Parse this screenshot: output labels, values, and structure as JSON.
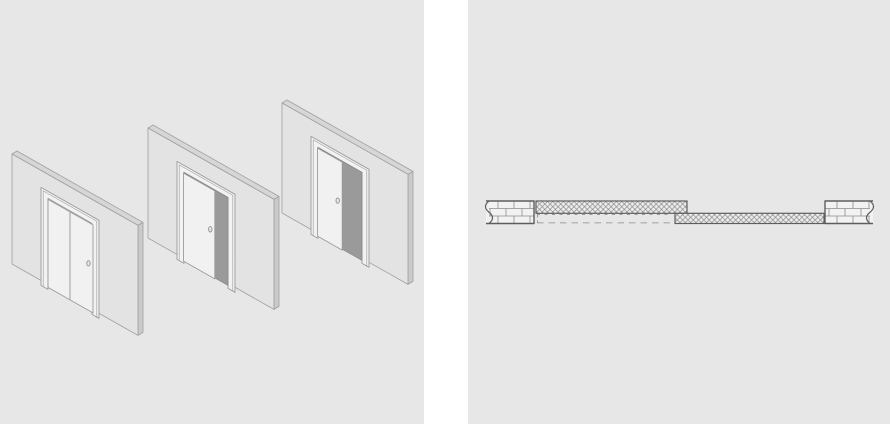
{
  "figure_subject": "sliding pocket door system - opening sequence (isometric) and plan section",
  "colors": {
    "gutter_bg": "#ffffff",
    "panel_bg": "#e7e7e7",
    "wall_face": "#e3e3e3",
    "wall_top": "#d6d6d6",
    "wall_side": "#cacaca",
    "wall_stroke": "#a0a0a0",
    "frame_fill": "#f2f2f2",
    "frame_stroke": "#9b9b9b",
    "leaf_fill": "#f1f1f1",
    "opening_fill": "#9a9a9a",
    "opening_stroke": "#868686",
    "handle_fill": "#e6e6e6",
    "handle_stroke": "#8d8d8d",
    "plan_outline": "#5e5e5e",
    "hatch_line": "#8a8a8a",
    "hatch_bg": "#ededed",
    "brick_fill": "#f2f2f2",
    "brick_joint": "#8c8c8c",
    "dash_line": "#9a9a9a",
    "dash_line_light": "#a8a8a8"
  },
  "isometric_panel": {
    "width": 424,
    "height": 424,
    "wall": {
      "width": 126,
      "height": 110,
      "slope": 0.567,
      "thickness_dx": 5,
      "thickness_dy": -3
    },
    "door_frame": {
      "outer_left": 29,
      "outer_right": 87,
      "outer_top": 17,
      "inner_left": 36,
      "inner_right": 80,
      "inner_top": 24,
      "opening_bottom": 112,
      "leg_bottom": 115,
      "leaf_top": 25,
      "leaf_bottom": 113,
      "handle_y": 66,
      "handle_inset": 4.5
    },
    "steps": [
      {
        "id": "door-closed",
        "origin_x": 12,
        "origin_y": 154,
        "open_fraction": 0,
        "split_panels": true
      },
      {
        "id": "door-partially-open",
        "origin_x": 148,
        "origin_y": 128,
        "open_fraction": 0.3,
        "split_panels": false
      },
      {
        "id": "door-half-open",
        "origin_x": 282,
        "origin_y": 103,
        "open_fraction": 0.45,
        "split_panels": false
      }
    ]
  },
  "plan_panel": {
    "width": 422,
    "height": 424,
    "wall_left": {
      "x": 18,
      "y": 201,
      "w": 48,
      "h": 22.5,
      "break_edge": "left"
    },
    "wall_right": {
      "x": 357,
      "y": 201,
      "w": 48,
      "h": 22.5,
      "break_edge": "right"
    },
    "pocket": {
      "x": 68,
      "y": 201,
      "w": 151,
      "h": 12.3
    },
    "door_panel": {
      "x": 207,
      "y": 213.3,
      "w": 149,
      "h": 10.2
    },
    "hidden_door": {
      "x": 69,
      "y": 214.5,
      "w": 133,
      "h": 8.3
    },
    "brick": {
      "rows": 3,
      "brick_length": 16,
      "row0_offset": 12,
      "row1_offset": 4
    },
    "hatch_cell": 5.3
  }
}
